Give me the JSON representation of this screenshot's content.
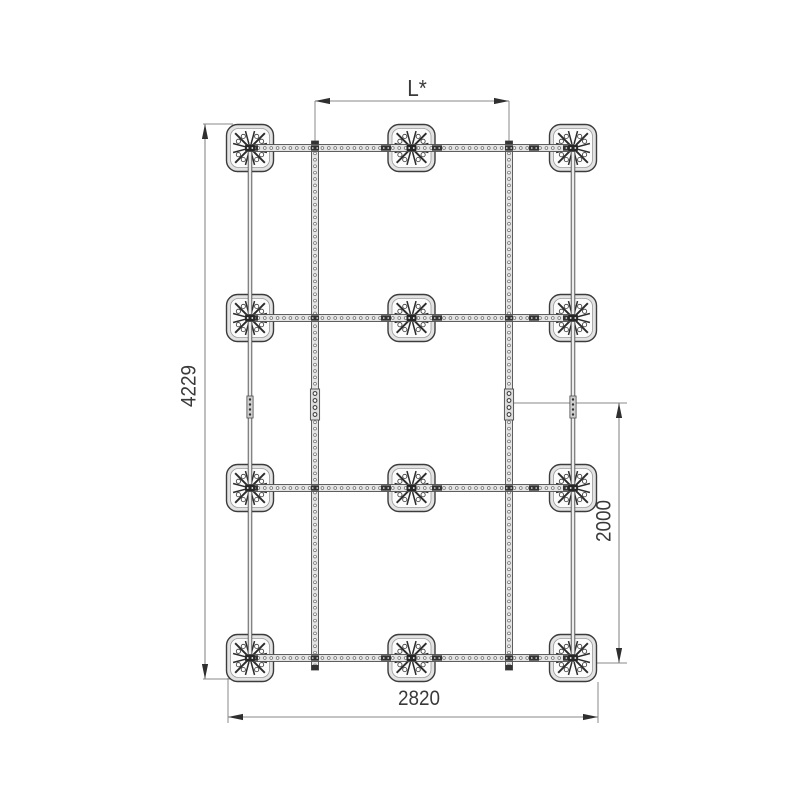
{
  "drawing": {
    "type": "technical-plan-drawing",
    "description": "Top view of a ground-anchor foundation grid with perforated mounting rails",
    "structure": {
      "anchor_plate_rows": 4,
      "anchor_plate_columns": 3,
      "anchor_plate_count": 12,
      "vertical_perforated_rails": 2,
      "vertical_edge_posts": 2,
      "horizontal_perforated_rails": 4,
      "rail_splice_joints": 4
    },
    "dimensions": {
      "top": {
        "label": "L*",
        "orientation": "horizontal"
      },
      "left": {
        "label": "4229",
        "orientation": "vertical"
      },
      "right": {
        "label": "2000",
        "orientation": "vertical"
      },
      "bottom": {
        "label": "2820",
        "orientation": "horizontal"
      }
    },
    "colors": {
      "background": "#ffffff",
      "structure_line": "#3c3c3c",
      "dimension_line": "#8a8a8a",
      "arrow": "#2f2f2f",
      "plate_fill": "#e3e3e3",
      "plate_inner_fill": "#fcfcfc",
      "rail_fill": "#e4e4e4",
      "bracket_fill": "#333333",
      "text": "#3a3a3a"
    }
  }
}
